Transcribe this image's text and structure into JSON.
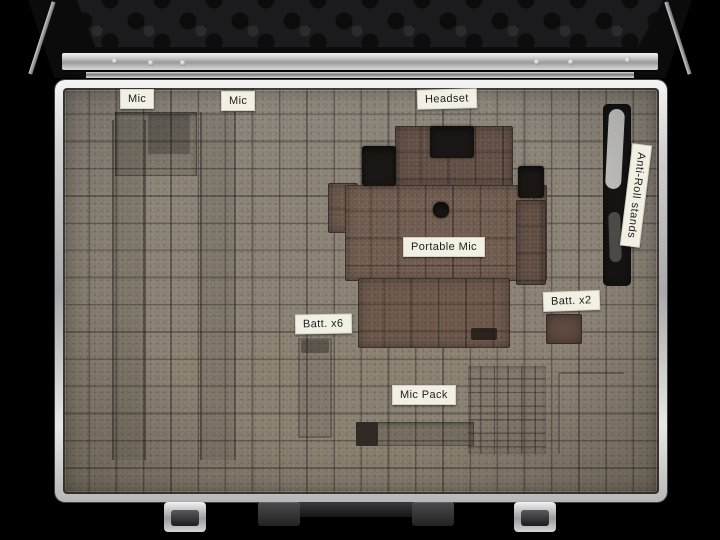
{
  "labels": {
    "mic1": "Mic",
    "mic2": "Mic",
    "headset": "Headset",
    "portable_mic": "Portable Mic",
    "batt_x6": "Batt. x6",
    "batt_x2": "Batt. x2",
    "mic_pack": "Mic Pack",
    "anti_roll": "Anti-Roll stands"
  },
  "colors": {
    "background": "#000000",
    "foam": "#8b8376",
    "foam_recess": "#756c5f",
    "cavity_brown_light": "#6f594d",
    "cavity_brown": "#6a5448",
    "cavity_brown_dark": "#5f4b40",
    "cavity_deep": "#100d0b",
    "aluminum": "#c9c9c9",
    "label_bg": "#f2efe3",
    "label_text": "#1d1d1d",
    "lid_foam": "#1b1a1c"
  }
}
